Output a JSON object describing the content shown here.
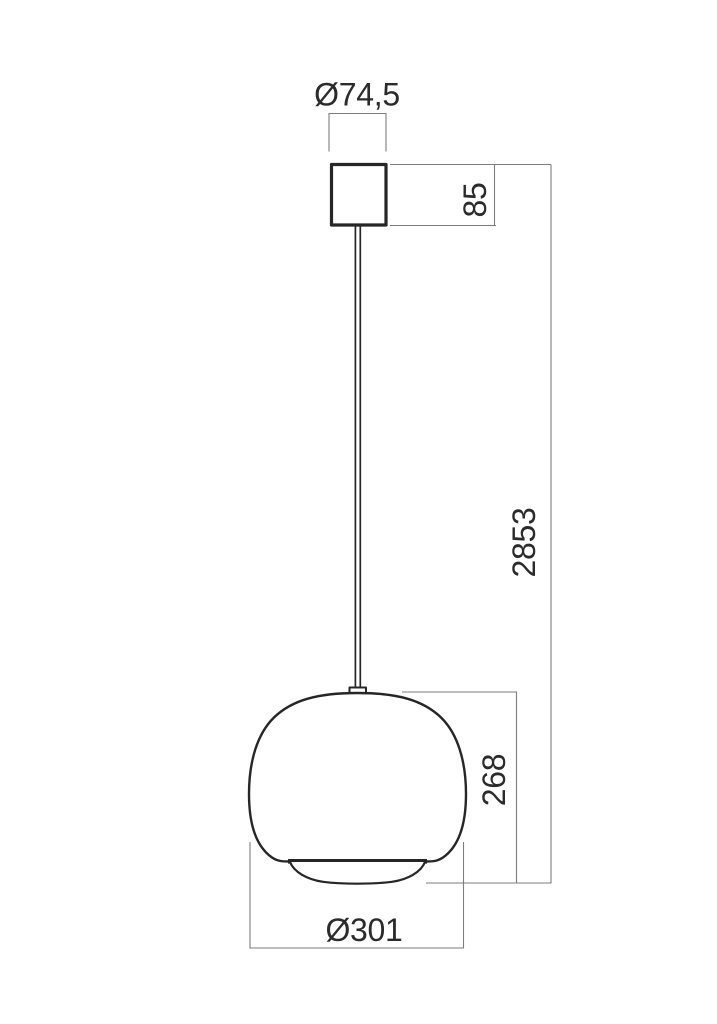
{
  "drawing": {
    "subject": "pendant-lamp-technical-drawing",
    "background_color": "#ffffff",
    "outline_color": "#262626",
    "dimension_line_color": "#7d7d7d",
    "dimension_text_color": "#2b2b2b"
  },
  "dimensions": {
    "canopy_diameter": {
      "label": "Ø74,5",
      "value": 74.5
    },
    "canopy_height": {
      "label": "85",
      "value": 85
    },
    "overall_drop": {
      "label": "2853",
      "value": 2853
    },
    "shade_height": {
      "label": "268",
      "value": 268
    },
    "shade_diameter": {
      "label": "Ø301",
      "value": 301
    }
  }
}
